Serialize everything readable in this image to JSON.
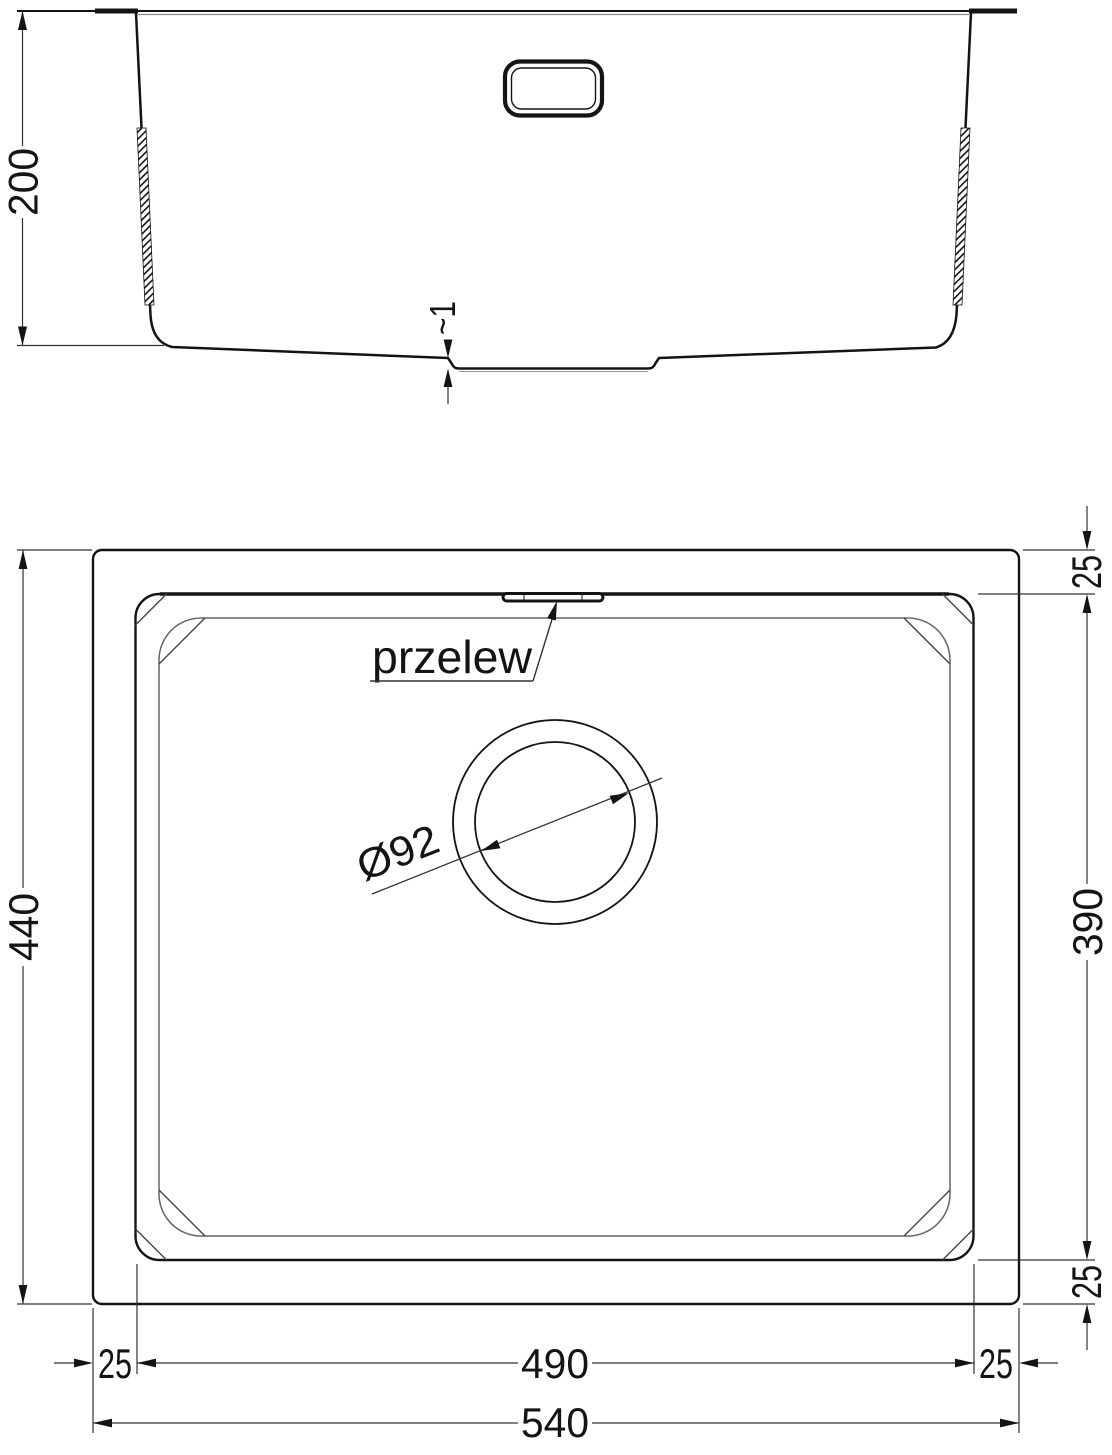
{
  "section_view": {
    "depth_dim": "200",
    "step_dim": "~1"
  },
  "plan_view": {
    "overflow_label": "przelew",
    "drain_diameter_dim": "Ø92",
    "outer_height_dim": "440",
    "bowl_height_dim": "390",
    "outer_width_dim": "540",
    "bowl_width_dim": "490",
    "margin_top_dim": "25",
    "margin_bottom_dim": "25",
    "margin_left_dim": "25",
    "margin_right_dim": "25"
  },
  "colors": {
    "main_line": "#141414",
    "dim_line": "#333333",
    "thin_line": "#888888",
    "background": "#ffffff"
  }
}
